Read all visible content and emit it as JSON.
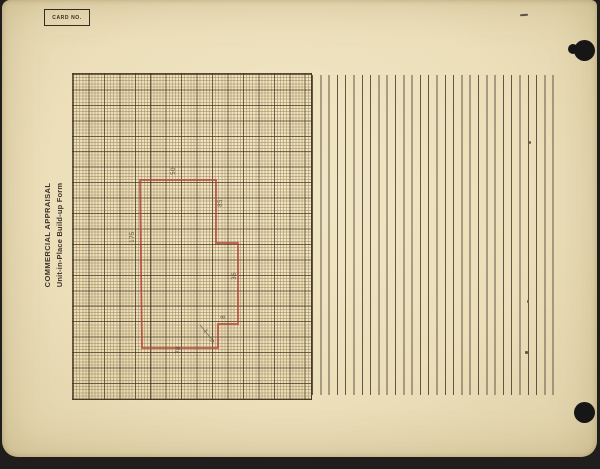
{
  "card": {
    "card_no_label": "CARD NO.",
    "title_line1": "COMMERCIAL APPRAISAL",
    "title_line2": "Unit-in-Place Build-up Form"
  },
  "sketch": {
    "description": "hand-drawn building footprint outline in red ink on grid paper",
    "outline_points": [
      [
        67,
        106
      ],
      [
        143,
        106
      ],
      [
        143,
        169
      ],
      [
        165,
        169
      ],
      [
        165,
        250
      ],
      [
        145,
        250
      ],
      [
        145,
        274
      ],
      [
        69,
        274
      ]
    ],
    "dimension_labels": [
      {
        "text": "50"
      },
      {
        "text": "85"
      },
      {
        "text": "36"
      },
      {
        "text": "8"
      },
      {
        "text": "78"
      },
      {
        "text": "175"
      }
    ]
  },
  "colors": {
    "card_background": "#eee2bd",
    "grid_fine_line": "#a08b5e",
    "grid_major_line": "#453823",
    "ruled_line": "#5e5644",
    "sketch_outline": "#b5463c",
    "punch_hole": "#161616"
  }
}
